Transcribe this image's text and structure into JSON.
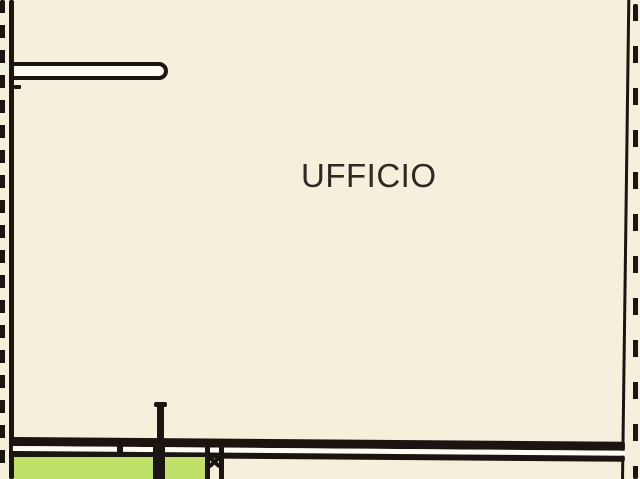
{
  "room": {
    "label": "UFFICIO"
  },
  "colors": {
    "background": "#f5efdb",
    "wall": "#1a1510",
    "terrace_green": "#c1e069",
    "cavity_white": "#fdfbf2",
    "label_text": "#2f2925"
  }
}
